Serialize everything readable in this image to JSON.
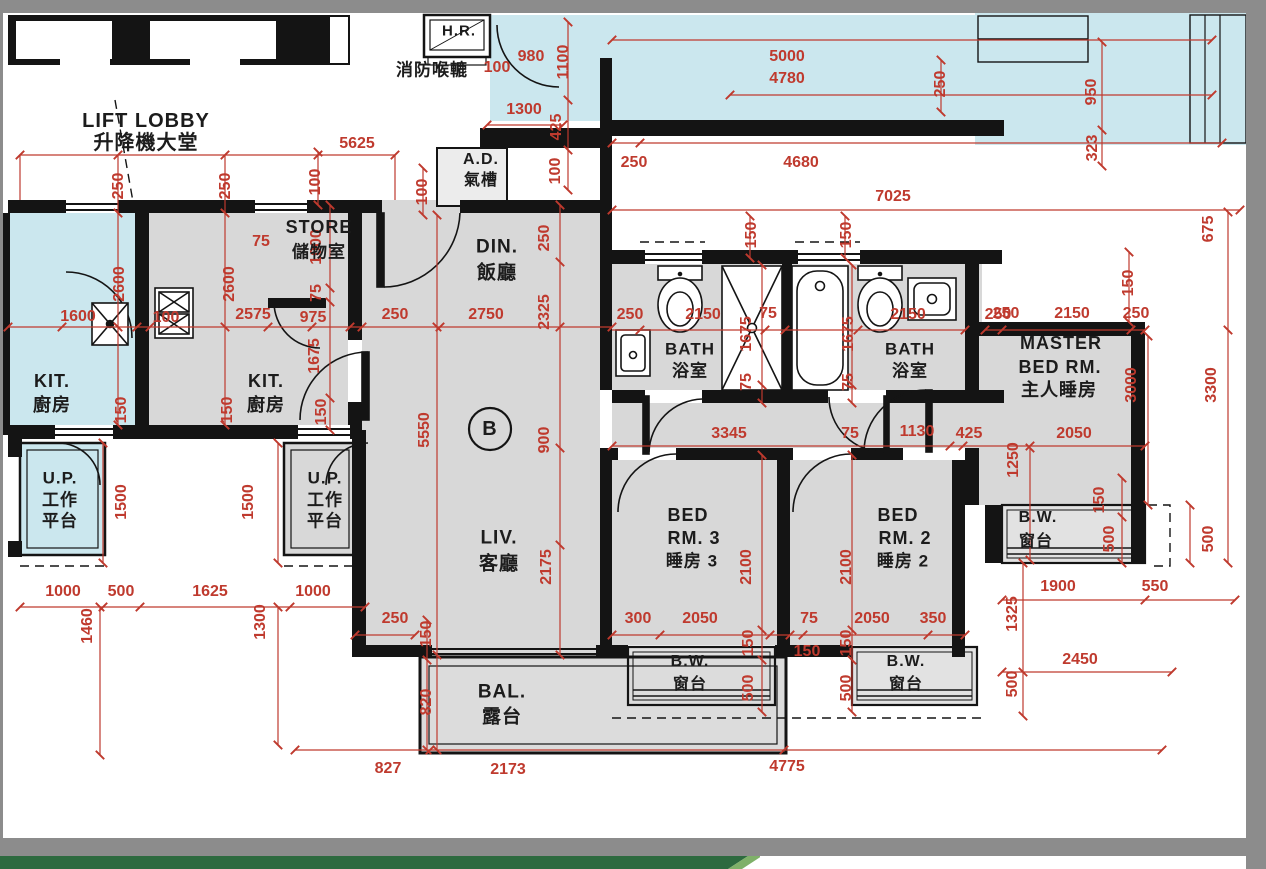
{
  "meta": {
    "drawing_type": "residential floor plan",
    "unit_label": "B",
    "colors": {
      "wall": "#141414",
      "dimension_red": "#bf3a2e",
      "adjacent_cyan": "#cbe7ee",
      "room_gray": "#d8d8d8",
      "chrome_gray": "#8c8c8c",
      "footer_green": "#2d6a3f",
      "footer_green_light": "#7fb069"
    }
  },
  "rooms": [
    [
      "LIFT LOBBY",
      146,
      121,
      20
    ],
    [
      "升降機大堂",
      146,
      143,
      20
    ],
    [
      "H.R.",
      459,
      31,
      15
    ],
    [
      "消防喉轆",
      432,
      70,
      17
    ],
    [
      "A.D.",
      481,
      160,
      16
    ],
    [
      "氣槽",
      481,
      181,
      16
    ],
    [
      "STORE",
      319,
      227,
      18
    ],
    [
      "儲物室",
      319,
      252,
      17
    ],
    [
      "DIN.",
      497,
      247,
      19
    ],
    [
      "飯廳",
      497,
      273,
      19
    ],
    [
      "KIT.",
      52,
      381,
      18
    ],
    [
      "廚房",
      52,
      405,
      18
    ],
    [
      "KIT.",
      266,
      381,
      18
    ],
    [
      "廚房",
      266,
      405,
      18
    ],
    [
      "U.P.",
      60,
      478,
      17
    ],
    [
      "工作",
      60,
      500,
      17
    ],
    [
      "平台",
      60,
      521,
      17
    ],
    [
      "U.P.",
      325,
      478,
      17
    ],
    [
      "工作",
      325,
      500,
      17
    ],
    [
      "平台",
      325,
      521,
      17
    ],
    [
      "LIV.",
      499,
      538,
      19
    ],
    [
      "客廳",
      499,
      564,
      19
    ],
    [
      "BATH",
      690,
      349,
      17
    ],
    [
      "浴室",
      690,
      371,
      17
    ],
    [
      "BATH",
      910,
      349,
      17
    ],
    [
      "浴室",
      910,
      371,
      17
    ],
    [
      "MASTER",
      1061,
      343,
      18
    ],
    [
      "BED RM.",
      1060,
      367,
      18
    ],
    [
      "主人睡房",
      1059,
      390,
      18
    ],
    [
      "BED",
      688,
      515,
      18
    ],
    [
      "RM. 3",
      694,
      538,
      18
    ],
    [
      "睡房 3",
      692,
      561,
      17
    ],
    [
      "BED",
      898,
      515,
      18
    ],
    [
      "RM. 2",
      905,
      538,
      18
    ],
    [
      "睡房 2",
      903,
      561,
      17
    ],
    [
      "B.W.",
      690,
      662,
      16
    ],
    [
      "窗台",
      690,
      685,
      16
    ],
    [
      "B.W.",
      906,
      662,
      16
    ],
    [
      "窗台",
      906,
      685,
      16
    ],
    [
      "B.W.",
      1038,
      518,
      16
    ],
    [
      "窗台",
      1036,
      542,
      16
    ],
    [
      "BAL.",
      502,
      692,
      19
    ],
    [
      "露台",
      502,
      717,
      19
    ],
    [
      "B",
      490,
      429,
      20
    ]
  ],
  "dims": [
    [
      "5625",
      357,
      144,
      0
    ],
    [
      "100",
      497,
      68,
      0
    ],
    [
      "980",
      531,
      57,
      0
    ],
    [
      "1100",
      564,
      62,
      1
    ],
    [
      "5000",
      787,
      57,
      0
    ],
    [
      "4780",
      787,
      79,
      0
    ],
    [
      "250",
      941,
      84,
      1
    ],
    [
      "950",
      1092,
      92,
      1
    ],
    [
      "323",
      1093,
      148,
      1
    ],
    [
      "1300",
      524,
      110,
      0
    ],
    [
      "425",
      557,
      127,
      1
    ],
    [
      "100",
      556,
      171,
      1
    ],
    [
      "250",
      634,
      163,
      0
    ],
    [
      "4680",
      801,
      163,
      0
    ],
    [
      "7025",
      893,
      197,
      0
    ],
    [
      "675",
      1209,
      229,
      1
    ],
    [
      "250",
      119,
      186,
      1
    ],
    [
      "250",
      226,
      186,
      1
    ],
    [
      "100",
      316,
      182,
      1
    ],
    [
      "100",
      423,
      192,
      1
    ],
    [
      "1600",
      78,
      317,
      0
    ],
    [
      "100",
      166,
      318,
      0
    ],
    [
      "2575",
      253,
      315,
      0
    ],
    [
      "975",
      313,
      318,
      0
    ],
    [
      "250",
      395,
      315,
      0
    ],
    [
      "2750",
      486,
      315,
      0
    ],
    [
      "75",
      261,
      242,
      0
    ],
    [
      "1000",
      317,
      247,
      1
    ],
    [
      "75",
      317,
      293,
      1
    ],
    [
      "1675",
      315,
      356,
      1
    ],
    [
      "2600",
      120,
      284,
      1
    ],
    [
      "2600",
      230,
      284,
      1
    ],
    [
      "150",
      122,
      410,
      1
    ],
    [
      "150",
      228,
      410,
      1
    ],
    [
      "150",
      322,
      412,
      1
    ],
    [
      "250",
      545,
      238,
      1
    ],
    [
      "2325",
      545,
      312,
      1
    ],
    [
      "900",
      545,
      440,
      1
    ],
    [
      "5550",
      425,
      430,
      1
    ],
    [
      "2175",
      547,
      567,
      1
    ],
    [
      "250",
      630,
      315,
      0
    ],
    [
      "2150",
      703,
      315,
      0
    ],
    [
      "75",
      768,
      314,
      0
    ],
    [
      "150",
      752,
      235,
      1
    ],
    [
      "1675",
      747,
      334,
      1
    ],
    [
      "75",
      747,
      382,
      1
    ],
    [
      "2150",
      908,
      315,
      0
    ],
    [
      "250",
      998,
      315,
      0
    ],
    [
      "150",
      847,
      235,
      1
    ],
    [
      "1675",
      849,
      334,
      1
    ],
    [
      "75",
      849,
      382,
      1
    ],
    [
      "250",
      1006,
      314,
      0
    ],
    [
      "2150",
      1072,
      314,
      0
    ],
    [
      "250",
      1136,
      314,
      0
    ],
    [
      "150",
      1129,
      283,
      1
    ],
    [
      "3000",
      1132,
      385,
      1
    ],
    [
      "3300",
      1212,
      385,
      1
    ],
    [
      "3345",
      729,
      434,
      0
    ],
    [
      "75",
      850,
      434,
      0
    ],
    [
      "1130",
      917,
      432,
      0
    ],
    [
      "425",
      969,
      434,
      0
    ],
    [
      "2050",
      1074,
      434,
      0
    ],
    [
      "1250",
      1014,
      460,
      1
    ],
    [
      "1500",
      122,
      502,
      1
    ],
    [
      "1500",
      249,
      502,
      1
    ],
    [
      "1000",
      63,
      592,
      0
    ],
    [
      "500",
      121,
      592,
      0
    ],
    [
      "1625",
      210,
      592,
      0
    ],
    [
      "1000",
      313,
      592,
      0
    ],
    [
      "1460",
      88,
      626,
      1
    ],
    [
      "1300",
      261,
      622,
      1
    ],
    [
      "250",
      395,
      619,
      0
    ],
    [
      "150",
      427,
      634,
      1
    ],
    [
      "820",
      427,
      702,
      1
    ],
    [
      "300",
      638,
      619,
      0
    ],
    [
      "2050",
      700,
      619,
      0
    ],
    [
      "75",
      809,
      619,
      0
    ],
    [
      "2050",
      872,
      619,
      0
    ],
    [
      "350",
      933,
      619,
      0
    ],
    [
      "2100",
      747,
      567,
      1
    ],
    [
      "2100",
      847,
      567,
      1
    ],
    [
      "150",
      749,
      643,
      1
    ],
    [
      "500",
      749,
      688,
      1
    ],
    [
      "150",
      807,
      652,
      0
    ],
    [
      "150",
      847,
      643,
      1
    ],
    [
      "500",
      847,
      688,
      1
    ],
    [
      "1900",
      1058,
      587,
      0
    ],
    [
      "550",
      1155,
      587,
      0
    ],
    [
      "1325",
      1013,
      614,
      1
    ],
    [
      "500",
      1013,
      684,
      1
    ],
    [
      "2450",
      1080,
      660,
      0
    ],
    [
      "150",
      1100,
      500,
      1
    ],
    [
      "500",
      1110,
      539,
      1
    ],
    [
      "500",
      1209,
      539,
      1
    ],
    [
      "827",
      388,
      769,
      0
    ],
    [
      "2173",
      508,
      770,
      0
    ],
    [
      "4775",
      787,
      767,
      0
    ]
  ]
}
